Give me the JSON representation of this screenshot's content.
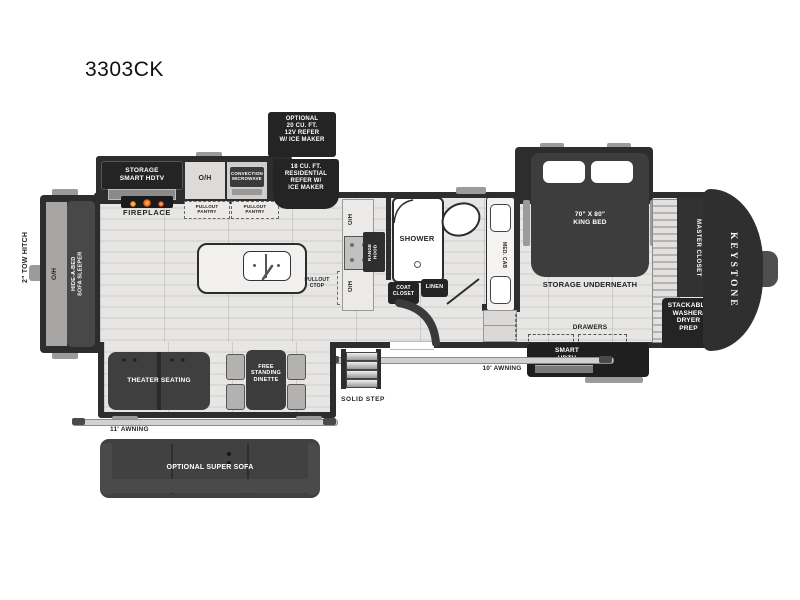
{
  "page": {
    "title": "3303CK",
    "brand": "KEYSTONE"
  },
  "colors": {
    "wall": "#2d2d2d",
    "floor": "#e2e1df",
    "dark_furniture": "#3f3f3f",
    "label_box": "#242424",
    "flame_accent": "#f2811e"
  },
  "labels": {
    "title": "3303CK",
    "tow_hitch": "2\" TOW HITCH",
    "sofa_oh": "O/H",
    "hide_a_bed": "HIDE-A-BED\nSOFA SLEEPER",
    "storage_hdtv": "STORAGE\nSMART HDTV",
    "fireplace": "FIREPLACE",
    "oh_top": "O/H",
    "microwave": "CONVECTION\nMICROWAVE",
    "pantry1": "PULLOUT\nPANTRY",
    "pantry2": "PULLOUT\nPANTRY",
    "opt_refer": "OPTIONAL\n20 CU. FT.\n12V REFER\nW/ ICE MAKER",
    "res_refer": "18 CU. FT.\nRESIDENTIAL\nREFER W/\nICE MAKER",
    "pullout_ctop": "PULLOUT\nCTOP",
    "oh_range_top": "O/H",
    "range_hood": "RANGE\nHOOD",
    "oh_range_bottom": "O/H",
    "shower": "SHOWER",
    "coat_closet": "COAT\nCLOSET",
    "linen": "LINEN",
    "med_cab": "MED. CAB",
    "king_bed": "70\" X 80\"\nKING BED",
    "storage_underneath": "STORAGE UNDERNEATH",
    "drawers": "DRAWERS",
    "smart_hdtv": "SMART\nHDTV",
    "master_closet": "MASTER CLOSET",
    "washer_dryer": "STACKABLE\nWASHER/\nDRYER\nPREP",
    "keystone": "KEYSTONE",
    "theater": "THEATER SEATING",
    "dinette": "FREE\nSTANDING\nDINETTE",
    "awning11": "11' AWNING",
    "awning10": "10' AWNING",
    "solid_step": "SOLID STEP",
    "super_sofa": "OPTIONAL SUPER SOFA"
  }
}
